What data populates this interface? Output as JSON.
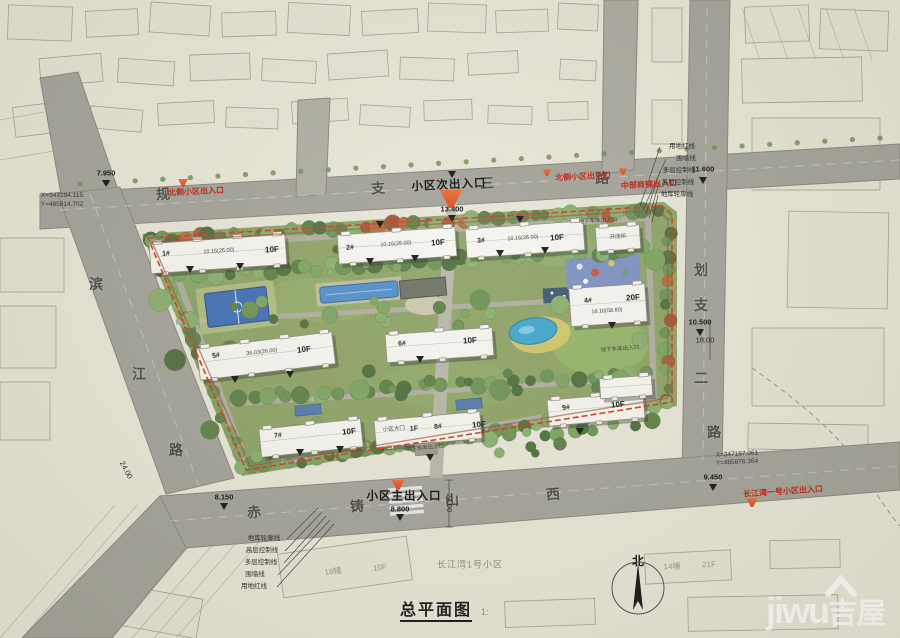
{
  "drawing": {
    "title": "总平面图",
    "scale": "1:",
    "compass_label": "北"
  },
  "watermark": {
    "brand": "jiwu",
    "brand_cn": "吉屋"
  },
  "colors": {
    "paper": "#e7e5d6",
    "road_gray": "#a09f95",
    "site_green": "#8ba164",
    "boundary_red": "#cf3b20",
    "entrance_orange": "#e2572f",
    "water_blue": "#4b87c8",
    "court_blue": "#3e6cb4",
    "building_white": "#f5f5ef"
  },
  "legend_topright": [
    "用地红线",
    "围墙线",
    "多层控制线",
    "高层控制线",
    "地库轮廓线"
  ],
  "legend_bottomleft": [
    "地库轮廓线",
    "高层控制线",
    "多层控制线",
    "围墙线",
    "用地红线"
  ],
  "roads": [
    "规划支路三",
    "规划支路二",
    "滨江路",
    "赤铸山西路"
  ],
  "buildings": [
    {
      "no": "1#",
      "floors": "10F"
    },
    {
      "no": "2#",
      "floors": "10F"
    },
    {
      "no": "3#",
      "floors": "10F"
    },
    {
      "no": "4#",
      "floors": "20F"
    },
    {
      "no": "5#",
      "floors": "10F"
    },
    {
      "no": "6#",
      "floors": "10F"
    },
    {
      "no": "7#",
      "floors": "10F"
    },
    {
      "no": "8#",
      "floors": "10F"
    },
    {
      "no": "9#",
      "floors": "10F"
    },
    {
      "no": "开闭所",
      "floors": ""
    }
  ],
  "annotations": [
    {
      "t": "规",
      "x": 163,
      "y": 194,
      "r": -4,
      "c": "road"
    },
    {
      "t": "支",
      "x": 378,
      "y": 188,
      "r": -3,
      "c": "road"
    },
    {
      "t": "三",
      "x": 487,
      "y": 183,
      "r": -3,
      "c": "road"
    },
    {
      "t": "路",
      "x": 602,
      "y": 178,
      "r": -3,
      "c": "road"
    },
    {
      "t": "划",
      "x": 701,
      "y": 270,
      "r": 0,
      "c": "road"
    },
    {
      "t": "支",
      "x": 701,
      "y": 305,
      "r": 0,
      "c": "road"
    },
    {
      "t": "二",
      "x": 701,
      "y": 378,
      "r": 0,
      "c": "road"
    },
    {
      "t": "滨",
      "x": 96,
      "y": 284,
      "r": 0,
      "c": "road"
    },
    {
      "t": "江",
      "x": 139,
      "y": 374,
      "r": 0,
      "c": "road"
    },
    {
      "t": "路",
      "x": 176,
      "y": 450,
      "r": 0,
      "c": "road"
    },
    {
      "t": "赤",
      "x": 254,
      "y": 512,
      "r": -4,
      "c": "road"
    },
    {
      "t": "铸",
      "x": 357,
      "y": 506,
      "r": -4,
      "c": "road"
    },
    {
      "t": "山",
      "x": 452,
      "y": 500,
      "r": -4,
      "c": "road"
    },
    {
      "t": "西",
      "x": 553,
      "y": 494,
      "r": -4,
      "c": "road"
    },
    {
      "t": "路",
      "x": 714,
      "y": 432,
      "r": -4,
      "c": "road"
    },
    {
      "t": "北侧小区出入口",
      "x": 196,
      "y": 192,
      "r": -3,
      "c": "red"
    },
    {
      "t": "北侧小区出入口",
      "x": 583,
      "y": 177,
      "r": -3,
      "c": "red"
    },
    {
      "t": "中部商铺出入口",
      "x": 649,
      "y": 185,
      "r": -3,
      "c": "red"
    },
    {
      "t": "长江湾一号小区出入口",
      "x": 783,
      "y": 492,
      "r": -4,
      "c": "red"
    },
    {
      "t": "小区次出入口",
      "x": 449,
      "y": 186,
      "r": -3,
      "c": "big"
    },
    {
      "t": "小区主出入口",
      "x": 404,
      "y": 497,
      "r": 0,
      "c": "big"
    },
    {
      "t": "7.950",
      "x": 106,
      "y": 173,
      "r": 0,
      "c": "elev"
    },
    {
      "t": "13.400",
      "x": 452,
      "y": 209,
      "r": 0,
      "c": "elev"
    },
    {
      "t": "11.600",
      "x": 703,
      "y": 169,
      "r": 0,
      "c": "elev"
    },
    {
      "t": "10.500",
      "x": 700,
      "y": 322,
      "r": 0,
      "c": "elev"
    },
    {
      "t": "8.150",
      "x": 224,
      "y": 497,
      "r": 0,
      "c": "elev"
    },
    {
      "t": "8.800",
      "x": 400,
      "y": 509,
      "r": 0,
      "c": "elev"
    },
    {
      "t": "9.450",
      "x": 713,
      "y": 477,
      "r": 0,
      "c": "elev"
    },
    {
      "t": "24.00",
      "x": 126,
      "y": 470,
      "r": 62,
      "c": "dim"
    },
    {
      "t": "24.00",
      "x": 449,
      "y": 503,
      "r": 90,
      "c": "dim"
    },
    {
      "t": "18.00",
      "x": 705,
      "y": 340,
      "r": 0,
      "c": "dim"
    },
    {
      "t": "X=347294.115",
      "x": 62,
      "y": 196,
      "r": 0,
      "c": "coord"
    },
    {
      "t": "Y=485814.702",
      "x": 62,
      "y": 205,
      "r": 0,
      "c": "coord"
    },
    {
      "t": "X=347187.061",
      "x": 737,
      "y": 455,
      "r": -3,
      "c": "coord"
    },
    {
      "t": "Y=485876.364",
      "x": 737,
      "y": 463,
      "r": -3,
      "c": "coord"
    },
    {
      "t": "1#",
      "x": 166,
      "y": 254,
      "r": -4,
      "c": "bnum"
    },
    {
      "t": "10.15(26.00)",
      "x": 219,
      "y": 252,
      "r": -4,
      "c": "bsm"
    },
    {
      "t": "10F",
      "x": 272,
      "y": 250,
      "r": -4,
      "c": "bfl"
    },
    {
      "t": "2#",
      "x": 350,
      "y": 248,
      "r": -4,
      "c": "bnum"
    },
    {
      "t": "10.15(26.00)",
      "x": 396,
      "y": 245,
      "r": -4,
      "c": "bsm"
    },
    {
      "t": "10F",
      "x": 438,
      "y": 243,
      "r": -4,
      "c": "bfl"
    },
    {
      "t": "3#",
      "x": 481,
      "y": 241,
      "r": -4,
      "c": "bnum"
    },
    {
      "t": "10.15(26.00)",
      "x": 523,
      "y": 239,
      "r": -4,
      "c": "bsm"
    },
    {
      "t": "10F",
      "x": 557,
      "y": 238,
      "r": -4,
      "c": "bfl"
    },
    {
      "t": "4#",
      "x": 588,
      "y": 301,
      "r": -4,
      "c": "bnum"
    },
    {
      "t": "18.10(58.60)",
      "x": 607,
      "y": 312,
      "r": -4,
      "c": "bsm"
    },
    {
      "t": "20F",
      "x": 633,
      "y": 298,
      "r": -4,
      "c": "bfl"
    },
    {
      "t": "5#",
      "x": 216,
      "y": 356,
      "r": -7,
      "c": "bnum"
    },
    {
      "t": "36.03(26.00)",
      "x": 262,
      "y": 353,
      "r": -7,
      "c": "bsm"
    },
    {
      "t": "10F",
      "x": 304,
      "y": 350,
      "r": -7,
      "c": "bfl"
    },
    {
      "t": "6#",
      "x": 402,
      "y": 344,
      "r": -4,
      "c": "bnum"
    },
    {
      "t": "10F",
      "x": 470,
      "y": 341,
      "r": -4,
      "c": "bfl"
    },
    {
      "t": "7#",
      "x": 278,
      "y": 436,
      "r": -6,
      "c": "bnum"
    },
    {
      "t": "10F",
      "x": 349,
      "y": 432,
      "r": -6,
      "c": "bfl"
    },
    {
      "t": "小区大门",
      "x": 394,
      "y": 430,
      "r": -5,
      "c": "bsm"
    },
    {
      "t": "1F",
      "x": 414,
      "y": 429,
      "r": -5,
      "c": "bnum"
    },
    {
      "t": "8#",
      "x": 438,
      "y": 427,
      "r": -5,
      "c": "bnum"
    },
    {
      "t": "10F",
      "x": 479,
      "y": 425,
      "r": -5,
      "c": "bfl"
    },
    {
      "t": "9#",
      "x": 566,
      "y": 408,
      "r": -5,
      "c": "bnum"
    },
    {
      "t": "10F",
      "x": 618,
      "y": 405,
      "r": -5,
      "c": "bfl"
    },
    {
      "t": "开闭所",
      "x": 618,
      "y": 238,
      "r": -4,
      "c": "bsm"
    },
    {
      "t": "地下车库出入口",
      "x": 598,
      "y": 222,
      "r": -3,
      "c": "bsm"
    },
    {
      "t": "地下车库出入口",
      "x": 425,
      "y": 449,
      "r": -5,
      "c": "bsm"
    },
    {
      "t": "地下车库出入口",
      "x": 620,
      "y": 350,
      "r": -4,
      "c": "bsm"
    },
    {
      "t": "长江湾1号小区",
      "x": 470,
      "y": 565,
      "r": 0,
      "c": "ctxname"
    },
    {
      "t": "18幢",
      "x": 333,
      "y": 572,
      "r": -8,
      "c": "ctx"
    },
    {
      "t": "10F",
      "x": 380,
      "y": 568,
      "r": -8,
      "c": "ctx"
    },
    {
      "t": "14幢",
      "x": 672,
      "y": 567,
      "r": -2,
      "c": "ctx"
    },
    {
      "t": "21F",
      "x": 709,
      "y": 565,
      "r": -2,
      "c": "ctx"
    },
    {
      "t": "用地红线",
      "x": 682,
      "y": 147,
      "r": 0,
      "c": "leg"
    },
    {
      "t": "围墙线",
      "x": 686,
      "y": 159,
      "r": 0,
      "c": "leg"
    },
    {
      "t": "多层控制线",
      "x": 679,
      "y": 171,
      "r": 0,
      "c": "leg"
    },
    {
      "t": "高层控制线",
      "x": 678,
      "y": 183,
      "r": 0,
      "c": "leg"
    },
    {
      "t": "地库轮廓线",
      "x": 677,
      "y": 195,
      "r": 0,
      "c": "leg"
    },
    {
      "t": "地库轮廓线",
      "x": 264,
      "y": 539,
      "r": 0,
      "c": "leg"
    },
    {
      "t": "高层控制线",
      "x": 262,
      "y": 551,
      "r": 0,
      "c": "leg"
    },
    {
      "t": "多层控制线",
      "x": 261,
      "y": 563,
      "r": 0,
      "c": "leg"
    },
    {
      "t": "围墙线",
      "x": 255,
      "y": 575,
      "r": 0,
      "c": "leg"
    },
    {
      "t": "用地红线",
      "x": 254,
      "y": 587,
      "r": 0,
      "c": "leg"
    }
  ],
  "markers": {
    "entrances": [
      {
        "x": 183,
        "y": 183,
        "s": 11
      },
      {
        "x": 451,
        "y": 199,
        "s": 26
      },
      {
        "x": 547,
        "y": 173,
        "s": 10
      },
      {
        "x": 623,
        "y": 172,
        "s": 10
      },
      {
        "x": 398,
        "y": 485,
        "s": 15
      },
      {
        "x": 752,
        "y": 503,
        "s": 13
      }
    ],
    "level_triangles": [
      [
        452,
        175
      ],
      [
        452,
        219
      ],
      [
        106,
        184
      ],
      [
        703,
        181
      ],
      [
        224,
        507
      ],
      [
        400,
        518
      ],
      [
        713,
        488
      ],
      [
        520,
        220
      ],
      [
        380,
        225
      ],
      [
        190,
        270
      ],
      [
        240,
        267
      ],
      [
        370,
        262
      ],
      [
        415,
        259
      ],
      [
        500,
        254
      ],
      [
        545,
        251
      ],
      [
        235,
        380
      ],
      [
        290,
        375
      ],
      [
        420,
        360
      ],
      [
        300,
        453
      ],
      [
        340,
        450
      ],
      [
        580,
        432
      ],
      [
        612,
        326
      ],
      [
        700,
        333
      ],
      [
        430,
        458
      ]
    ]
  }
}
